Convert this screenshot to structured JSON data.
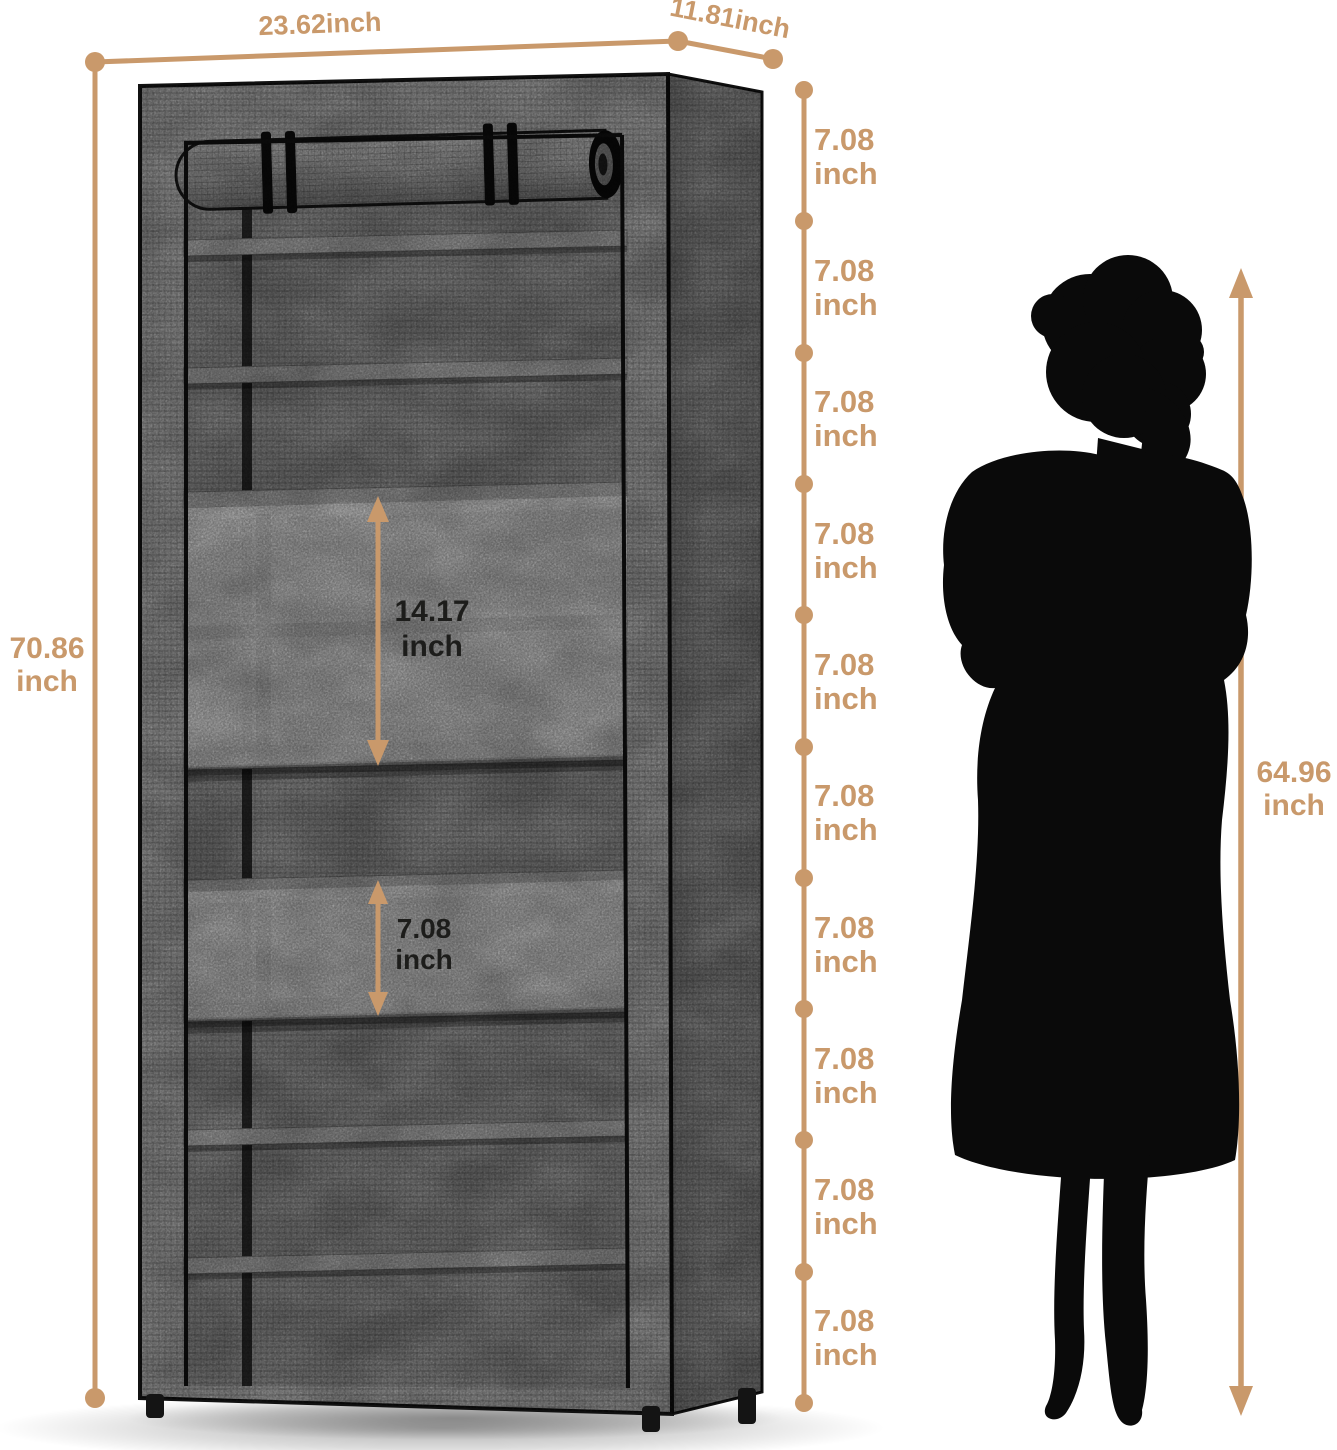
{
  "colors": {
    "accent": "#C9996B",
    "ink": "#1d1d1b",
    "silhouette": "#0a0a0a",
    "fabric_light": "#d6d6d6",
    "fabric_mid": "#c4c4c4",
    "fabric_side": "#bdbdbd"
  },
  "labels": {
    "width": "23.62inch",
    "depth": "11.81inch",
    "height_value": "70.86",
    "height_unit": "inch",
    "double_shelf_value": "14.17",
    "double_shelf_unit": "inch",
    "single_shelf_value": "7.08",
    "single_shelf_unit": "inch",
    "person_value": "64.96",
    "person_unit": "inch"
  },
  "tiers": [
    {
      "value": "7.08",
      "unit": "inch"
    },
    {
      "value": "7.08",
      "unit": "inch"
    },
    {
      "value": "7.08",
      "unit": "inch"
    },
    {
      "value": "7.08",
      "unit": "inch"
    },
    {
      "value": "7.08",
      "unit": "inch"
    },
    {
      "value": "7.08",
      "unit": "inch"
    },
    {
      "value": "7.08",
      "unit": "inch"
    },
    {
      "value": "7.08",
      "unit": "inch"
    },
    {
      "value": "7.08",
      "unit": "inch"
    },
    {
      "value": "7.08",
      "unit": "inch"
    }
  ]
}
